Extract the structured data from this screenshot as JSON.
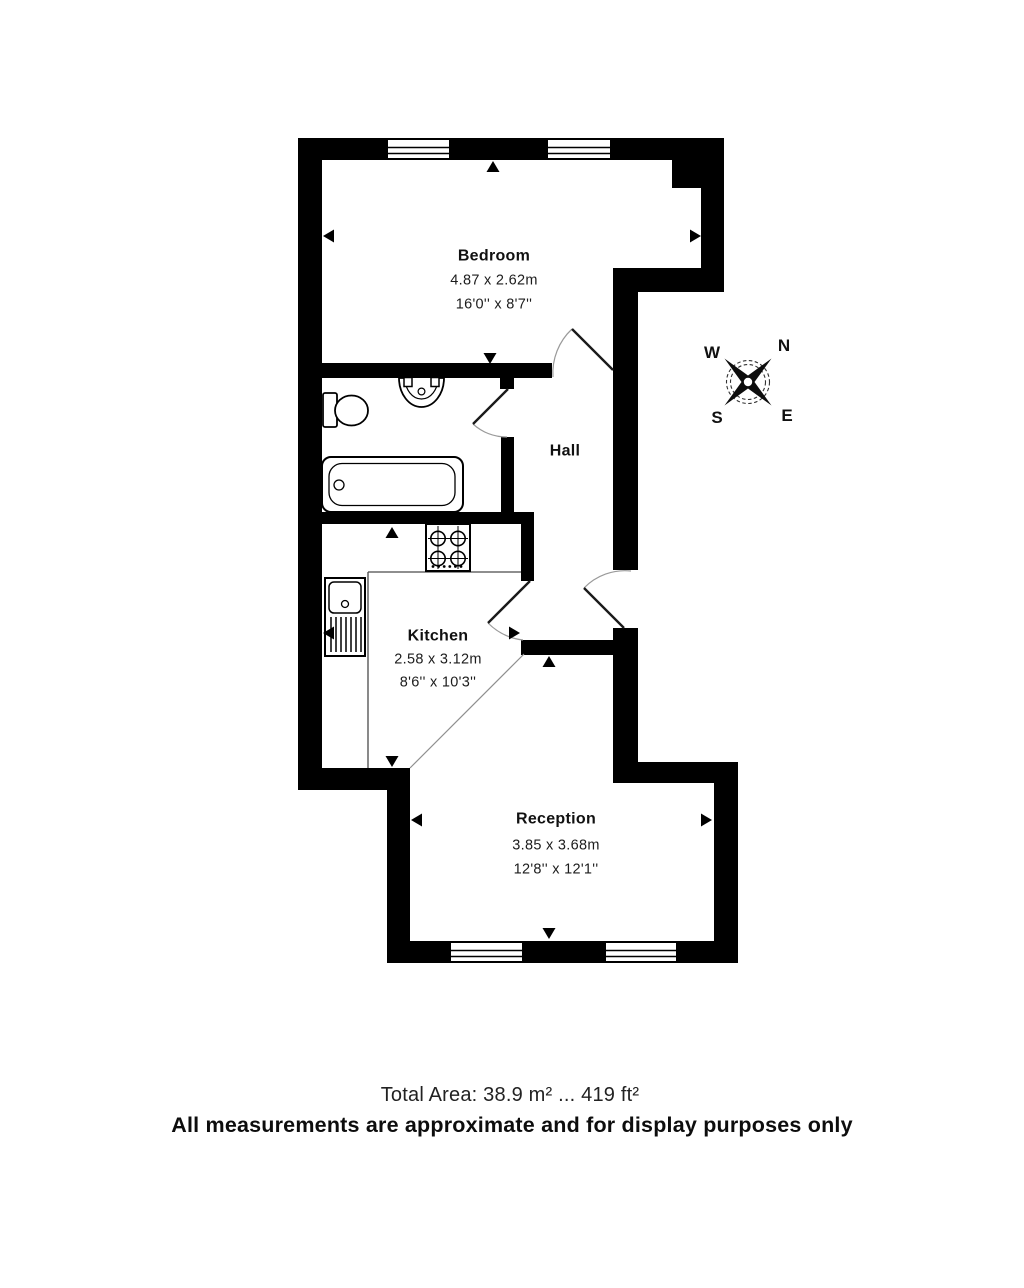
{
  "plan": {
    "rooms": {
      "bedroom": {
        "name": "Bedroom",
        "metric": "4.87 x 2.62m",
        "imperial": "16'0'' x 8'7''"
      },
      "hall": {
        "name": "Hall"
      },
      "kitchen": {
        "name": "Kitchen",
        "metric": "2.58 x 3.12m",
        "imperial": "8'6'' x 10'3''"
      },
      "reception": {
        "name": "Reception",
        "metric": "3.85 x 3.68m",
        "imperial": "12'8'' x 12'1''"
      }
    },
    "compass": {
      "n": "N",
      "e": "E",
      "s": "S",
      "w": "W"
    },
    "footer": {
      "total_area": "Total Area: 38.9 m² ... 419 ft²",
      "disclaimer": "All measurements are approximate and for display purposes only"
    },
    "colors": {
      "wall": "#000000",
      "background": "#ffffff"
    }
  }
}
